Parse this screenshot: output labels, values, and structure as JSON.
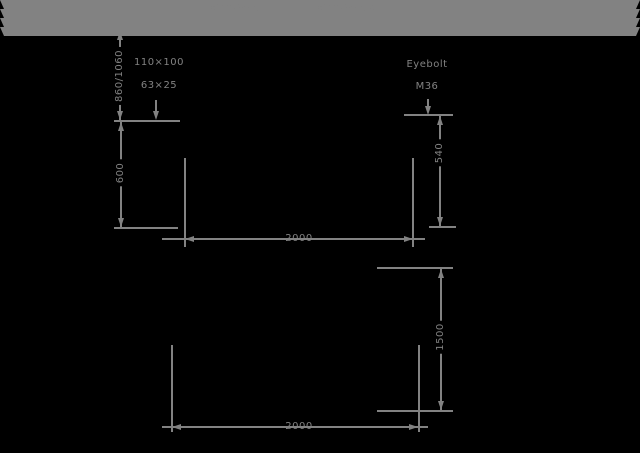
{
  "colors": {
    "background": "#000000",
    "ink": "#828282"
  },
  "front_view": {
    "lug_left_label": "φ36(GB825)",
    "lug_right_label": "φ36(GB825)-2",
    "cable_block": {
      "line1": "110×100",
      "line2": "63×25"
    },
    "eyebolt_block": {
      "line1": "Eyebolt",
      "line2": "M36"
    },
    "dim_lift_height": "860/1060",
    "dim_left_height": "600",
    "dim_right_height": "540",
    "dim_width": "2000"
  },
  "plan_view": {
    "dim_depth": "1500",
    "dim_width": "2000"
  }
}
